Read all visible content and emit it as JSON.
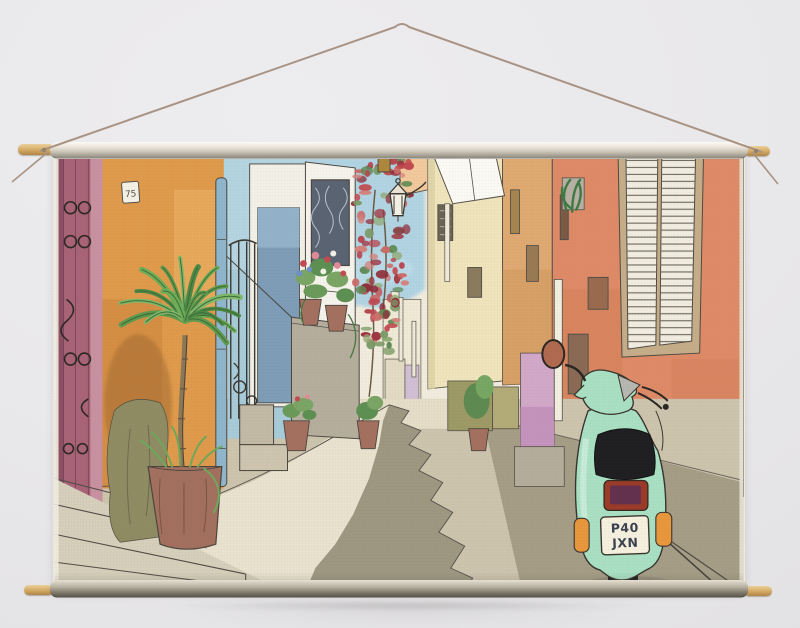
{
  "scene": {
    "type": "product-photo",
    "subject": "Watercolor street-scene tapestry wall hanging suspended from wooden dowels by a cord",
    "background_color": "#e9e8ea"
  },
  "hanger": {
    "cord_color": "#a89384",
    "dowel_wood_color": "#d3a964",
    "top_sleeve_color": "#c9c3b6",
    "bottom_sleeve_color": "#7d776b"
  },
  "artwork": {
    "medium": "pen and watercolor",
    "description": "Narrow Mediterranean alley with plum, orange, blue, cream and salmon house fronts, palm tree in a terracotta planter, wrought-iron gates, potted geraniums, climbing bougainvillea, a street lantern, white louvered shutters and a parked mint-green scooter",
    "house_plaque_number": "75",
    "scooter": {
      "license_plate_line1": "P40",
      "license_plate_line2": "JXN",
      "body_color": "#a9e0c3",
      "seat_color": "#1f1f22",
      "tail_light_color": "#9c3a28",
      "indicator_color": "#e8973c"
    },
    "palette": {
      "paper": "#f1ecdd",
      "sky": "#aad2e3",
      "plum_wall": "#a96378",
      "orange_wall": "#e09a4b",
      "pale_blue_wall": "#b5d4e1",
      "slate_blue_door": "#7e9db8",
      "drainpipe_blue": "#8fb6cd",
      "pale_yellow_building": "#f0e4bc",
      "tan_building": "#dfa972",
      "salmon_wall": "#de8a67",
      "shutter_white": "#f1ede1",
      "pink_wall": "#d2a8c8",
      "olive_wall": "#9d9a66",
      "street_light": "#e9e2cf",
      "street_mid": "#cdc4ae",
      "street_shadow": "#9e9781",
      "terracotta_pot": "#a3705f",
      "palm_green": "#5f9a4e",
      "bougainvillea_red": "#b8424d",
      "ink": "#4a463f"
    }
  }
}
